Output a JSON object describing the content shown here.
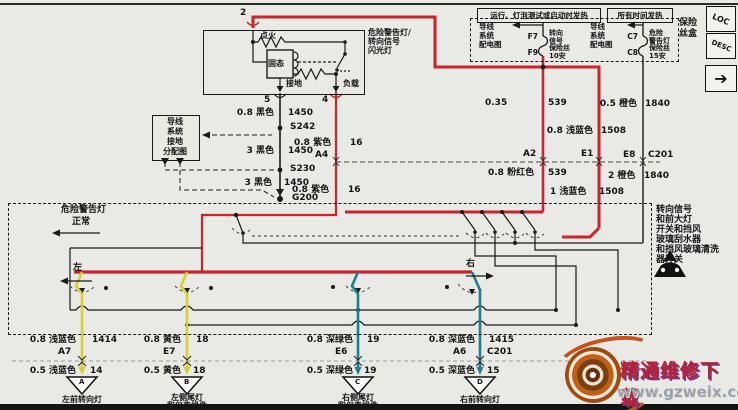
{
  "colors": {
    "highlight_red": "#c8252c",
    "yellow_wire": "#d6cf2e",
    "teal_wire": "#1b7f8e",
    "background": "#e9e9e6"
  },
  "pins": {
    "pin2": "2",
    "pin5": "5",
    "pin4": "4"
  },
  "flasher": {
    "ignition": "点火",
    "solid_state": "固态",
    "ground": "接地",
    "load": "负载",
    "name_l1": "危险警告灯/",
    "name_l2": "转向信号",
    "name_l3": "闪光灯"
  },
  "fusebox": {
    "header_run": "运行、灯泡测试或启动时发热",
    "header_all": "所有时间发热",
    "box_label_l1": "保险",
    "box_label_l2": "丝盒",
    "ref_l1": "导线",
    "ref_l2": "系统",
    "ref_l3": "配电图",
    "f7": "F7",
    "f9": "F9",
    "turn_l1": "转向",
    "turn_l2": "信号",
    "turn_l3": "保险丝",
    "turn_l4": "10安",
    "c7": "C7",
    "c8": "C8",
    "haz_l1": "危险",
    "haz_l2": "警告灯",
    "haz_l3": "保险丝",
    "haz_l4": "15安",
    "loc": "LOC",
    "desc": "DESC",
    "next": "➔"
  },
  "ground_ref": {
    "l1": "导线",
    "l2": "系统",
    "l3": "接地",
    "l4": "分配图"
  },
  "ground_wire": {
    "g1": "0.8 黑色",
    "c1": "1450",
    "s242": "S242",
    "g2": "3 黑色",
    "c2": "1450",
    "s230": "S230",
    "g3": "3 黑色",
    "c3": "1450",
    "g200": "G200"
  },
  "load_wire": {
    "g1": "0.8 紫色",
    "c1": "16",
    "conn": "A4",
    "g2": "0.8 紫色",
    "c2": "16"
  },
  "feed": {
    "g539": "0.35",
    "c539": "539",
    "g1508": "0.8 浅蓝色",
    "c1508": "1508",
    "g1840": "0.5 橙色",
    "c1840": "1840",
    "a2": "A2",
    "e1": "E1",
    "e8": "E8",
    "c201": "C201",
    "g539b": "0.8 粉红色",
    "c539b": "539",
    "g1508b": "1 浅蓝色",
    "c1508b": "1508",
    "g1840b": "2 橙色",
    "c1840b": "1840"
  },
  "switchbox": {
    "hazard": "危险警告灯",
    "normal": "正常",
    "left": "左",
    "right": "右",
    "note_l1": "转向信号",
    "note_l2": "和前大灯",
    "note_l3": "开关和挡风",
    "note_l4": "玻璃刮水器",
    "note_l5": "和挡风玻璃清洗",
    "note_l6": "器开关"
  },
  "outputs": [
    {
      "gt": "0.8 浅蓝色",
      "ct": "1414",
      "conn": "A7",
      "conn2": "",
      "gb": "0.5 浅蓝色",
      "cb": "14",
      "tri": "A",
      "l1": "左前转向灯",
      "l2": ""
    },
    {
      "gt": "0.8 黄色",
      "ct": "18",
      "conn": "E7",
      "conn2": "",
      "gb": "0.5 黄色",
      "cb": "18",
      "tri": "B",
      "l1": "左侧尾灯",
      "l2": "和仪表组件"
    },
    {
      "gt": "0.8 深绿色",
      "ct": "19",
      "conn": "E6",
      "conn2": "",
      "gb": "0.5 深绿色",
      "cb": "19",
      "tri": "C",
      "l1": "右侧尾灯",
      "l2": "和仪表组件"
    },
    {
      "gt": "0.8 深蓝色",
      "ct": "1415",
      "conn": "A6",
      "conn2": "C201",
      "gb": "0.5 深蓝色",
      "cb": "15",
      "tri": "D",
      "l1": "右前转向灯",
      "l2": ""
    }
  ],
  "watermark": {
    "title": "精通维修下载",
    "url": "www.gzweix.com"
  }
}
